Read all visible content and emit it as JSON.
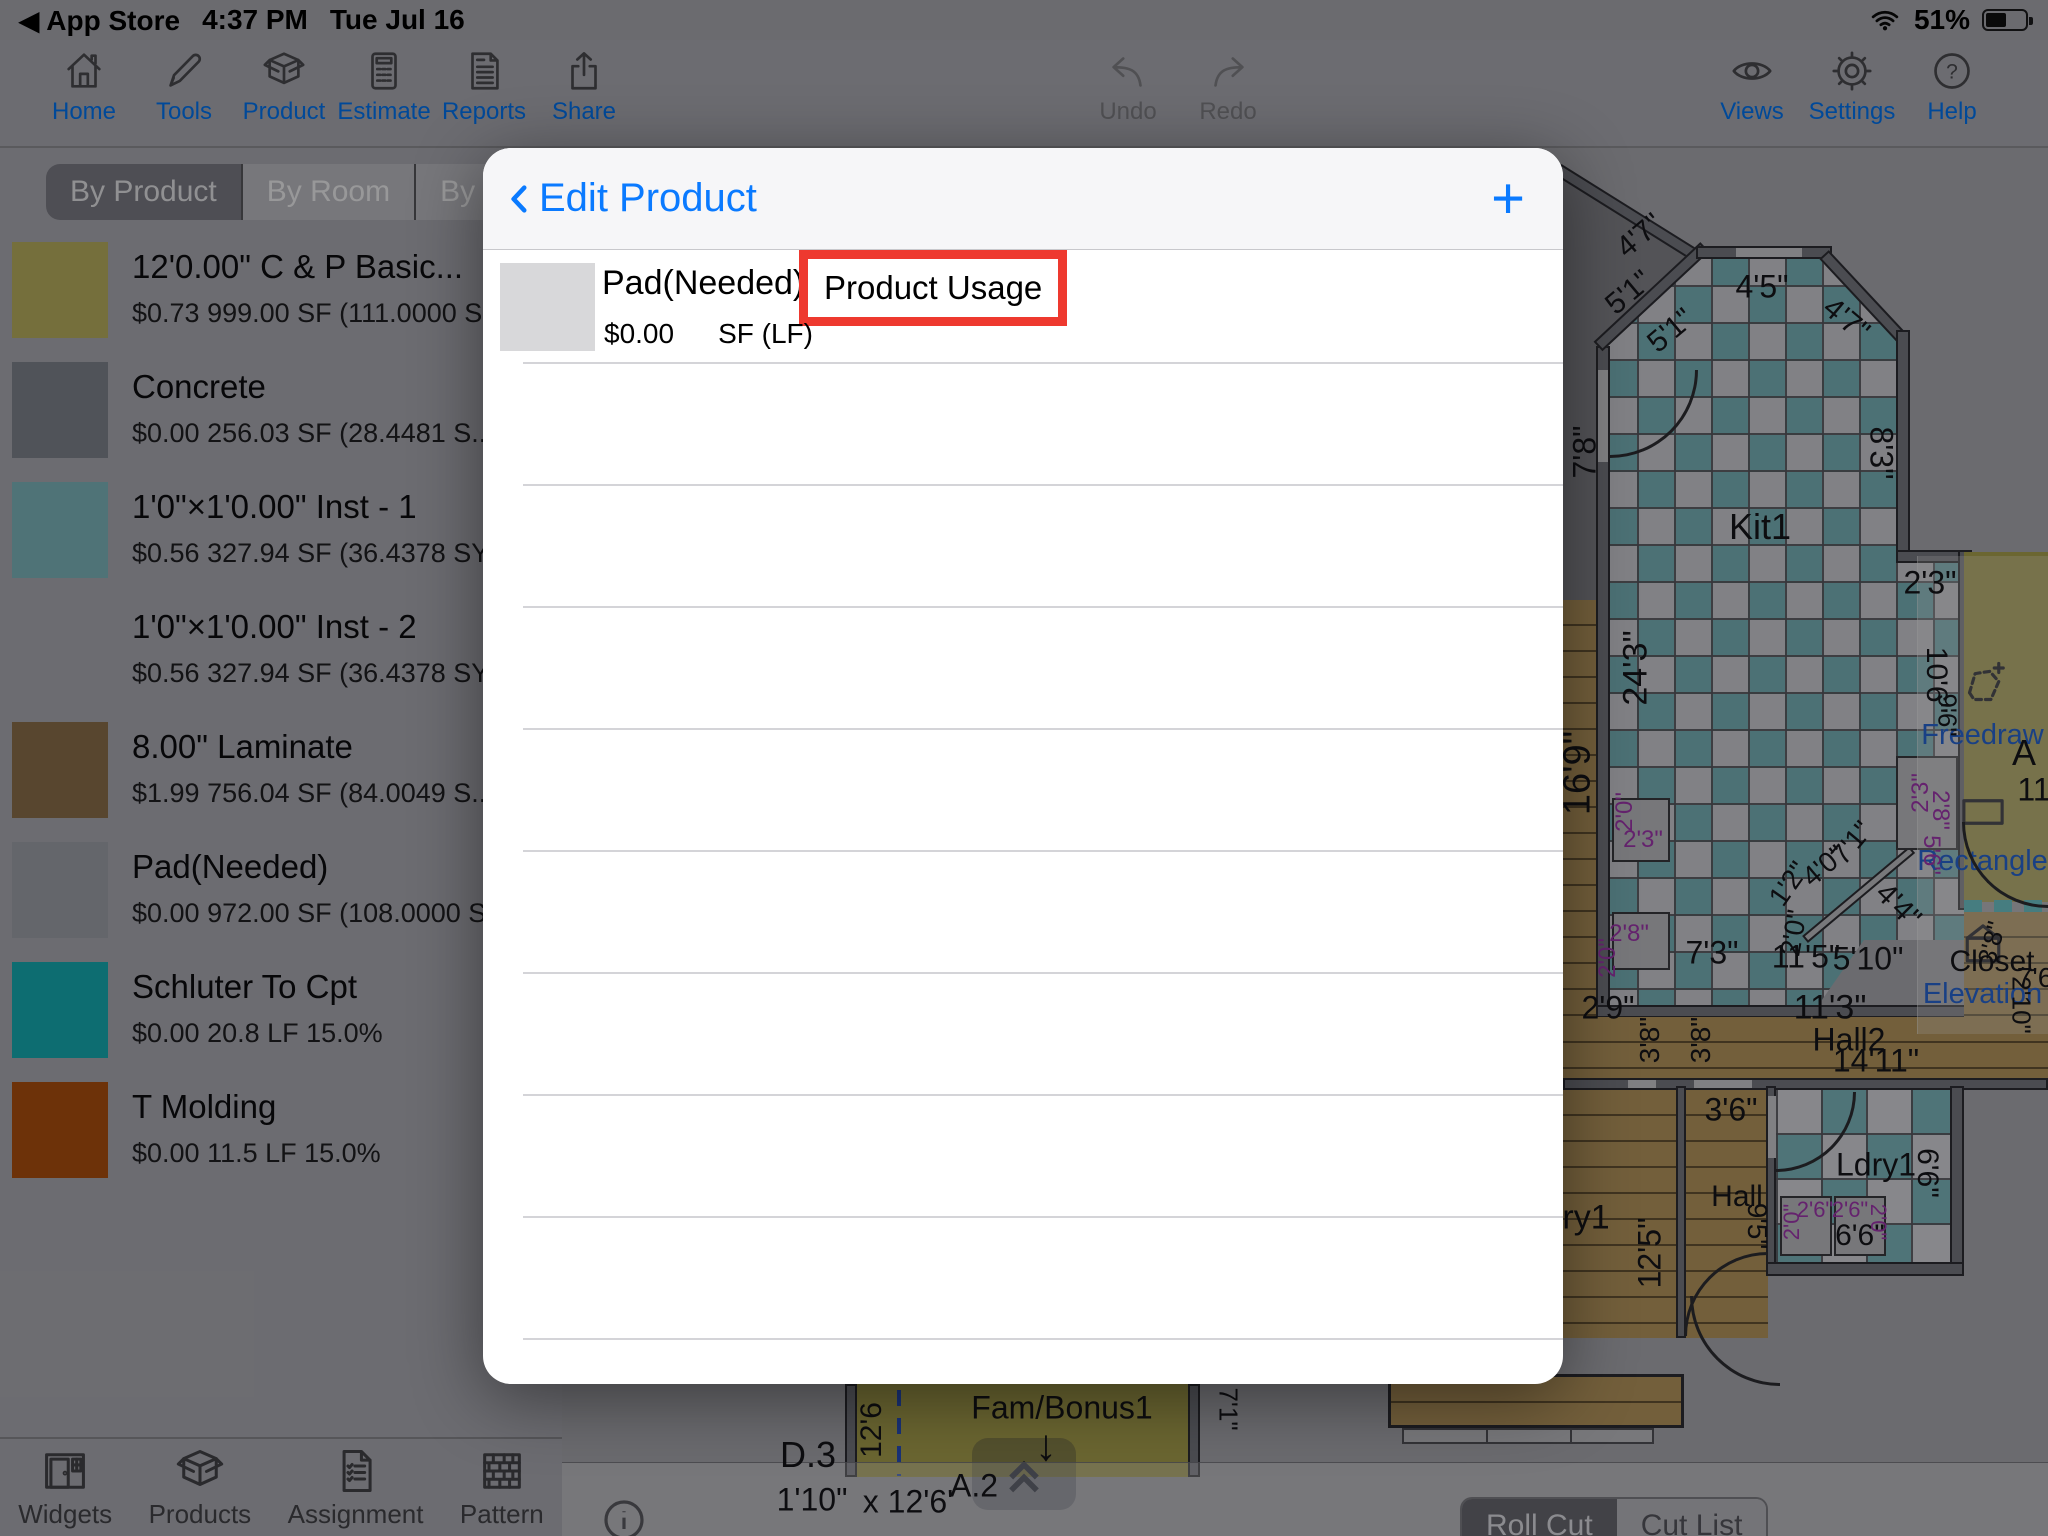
{
  "status_bar": {
    "back": "◀ App Store",
    "time": "4:37 PM",
    "date": "Tue Jul 16",
    "battery_percent": "51%",
    "wifi_icon": "wifi-icon",
    "battery_icon": "battery-icon"
  },
  "toolbar": {
    "accent": "#007aff",
    "left": [
      {
        "icon": "home-icon",
        "label": "Home"
      },
      {
        "icon": "pencil-icon",
        "label": "Tools"
      },
      {
        "icon": "box-icon",
        "label": "Product"
      },
      {
        "icon": "calculator-icon",
        "label": "Estimate"
      },
      {
        "icon": "document-icon",
        "label": "Reports"
      },
      {
        "icon": "share-icon",
        "label": "Share"
      }
    ],
    "center": [
      {
        "icon": "undo-icon",
        "label": "Undo",
        "disabled": true
      },
      {
        "icon": "redo-icon",
        "label": "Redo",
        "disabled": true
      }
    ],
    "right": [
      {
        "icon": "eye-icon",
        "label": "Views"
      },
      {
        "icon": "gear-icon",
        "label": "Settings"
      },
      {
        "icon": "help-icon",
        "label": "Help"
      }
    ]
  },
  "sidebar": {
    "tabs": [
      {
        "label": "By Product",
        "selected": true
      },
      {
        "label": "By Room",
        "selected": false
      },
      {
        "label": "By Patte",
        "selected": false
      }
    ],
    "products": [
      {
        "name": "12'0.00\" C & P Basic...",
        "details": "$0.73 999.00 SF (111.0000 S...",
        "swatch": "#c3b964"
      },
      {
        "name": "Concrete",
        "details": "$0.00 256.03 SF (28.4481 S...",
        "swatch": "#868a94"
      },
      {
        "name": "1'0\"×1'0.00\" Inst -  1",
        "details": "$0.56 327.94 SF (36.4378 SY...",
        "swatch": "#84c0c6"
      },
      {
        "name": "1'0\"×1'0.00\" Inst -  2",
        "details": "$0.56 327.94 SF (36.4378 SY...",
        "swatch": null
      },
      {
        "name": "8.00\" Laminate",
        "details": "$1.99 756.04 SF (84.0049 S...",
        "swatch": "#93764f"
      },
      {
        "name": "Pad(Needed)",
        "details": "$0.00 972.00 SF (108.0000 S...",
        "swatch": "#a7aab2"
      },
      {
        "name": "Schluter To Cpt",
        "details": "$0.00 20.8 LF 15.0%",
        "swatch": "#16b6bd"
      },
      {
        "name": "T Molding",
        "details": "$0.00 11.5 LF 15.0%",
        "swatch": "#b65410"
      }
    ]
  },
  "bottom_bar": {
    "items": [
      {
        "icon": "widgets-icon",
        "label": "Widgets"
      },
      {
        "icon": "box-icon",
        "label": "Products"
      },
      {
        "icon": "assignment-icon",
        "label": "Assignment"
      },
      {
        "icon": "pattern-icon",
        "label": "Pattern"
      }
    ]
  },
  "modal": {
    "title": "Edit Product",
    "add_button": "+",
    "row": {
      "name": "Pad(Needed)",
      "usage_label": "Product Usage",
      "price": "$0.00",
      "unit": "SF (LF)",
      "swatch": "#d8d8da"
    }
  },
  "annotation": {
    "highlight_color": "#ee392f"
  },
  "canvas": {
    "info_icon": "i",
    "cut_tabs": [
      {
        "label": "Roll Cut",
        "selected": true
      },
      {
        "label": "Cut List",
        "selected": false
      }
    ],
    "palette": {
      "accent": "#2b6cde",
      "items": [
        {
          "icon": "freedraw-icon",
          "label": "Freedraw",
          "y": 737
        },
        {
          "icon": "rectangle-icon",
          "label": "Rectangle",
          "y": 863
        },
        {
          "icon": "elevation-icon",
          "label": "Elevation",
          "y": 996
        }
      ]
    },
    "colors": {
      "tile_teal": "#7fbdc3",
      "tile_light": "#d8d8de",
      "wood": "#c09f63",
      "olive": "#b3aa52",
      "purple": "#a83ab8",
      "wall": "#7e7f88"
    },
    "plan_labels": [
      {
        "t": "4'7\"",
        "x": 1640,
        "y": 236,
        "r": -40,
        "s": 30
      },
      {
        "t": "5'1\"",
        "x": 1629,
        "y": 293,
        "r": -40,
        "s": 30
      },
      {
        "t": "5'1\"",
        "x": 1671,
        "y": 331,
        "r": -40,
        "s": 30
      },
      {
        "t": "4'5\"",
        "x": 1762,
        "y": 287,
        "r": 0,
        "s": 32
      },
      {
        "t": "4'7\"",
        "x": 1846,
        "y": 320,
        "r": 40,
        "s": 30
      },
      {
        "t": "7'8\"",
        "x": 1585,
        "y": 452,
        "r": -90,
        "s": 32
      },
      {
        "t": "8'3\"",
        "x": 1881,
        "y": 453,
        "r": 90,
        "s": 32
      },
      {
        "t": "Kit1",
        "x": 1760,
        "y": 527,
        "r": 0,
        "s": 36
      },
      {
        "t": "2'3\"",
        "x": 1930,
        "y": 583,
        "r": 0,
        "s": 32
      },
      {
        "t": "24'3\"",
        "x": 1636,
        "y": 668,
        "r": -90,
        "s": 34
      },
      {
        "t": "16'9\"",
        "x": 1578,
        "y": 773,
        "r": -90,
        "s": 38
      },
      {
        "t": "10'6\"",
        "x": 1936,
        "y": 680,
        "r": 90,
        "s": 30
      },
      {
        "t": "9'6\"",
        "x": 1947,
        "y": 715,
        "r": 90,
        "s": 26
      },
      {
        "t": "2'0\"",
        "x": 1625,
        "y": 812,
        "r": -90,
        "s": 24,
        "c": "purple"
      },
      {
        "t": "2'3\"",
        "x": 1643,
        "y": 840,
        "r": 0,
        "s": 24,
        "c": "purple"
      },
      {
        "t": "2'8\"",
        "x": 1629,
        "y": 934,
        "r": 0,
        "s": 24,
        "c": "purple"
      },
      {
        "t": "2'0\"",
        "x": 1608,
        "y": 958,
        "r": -90,
        "s": 24,
        "c": "purple"
      },
      {
        "t": "2'3\"",
        "x": 1921,
        "y": 793,
        "r": -90,
        "s": 24,
        "c": "purple"
      },
      {
        "t": "2'8\"",
        "x": 1940,
        "y": 810,
        "r": 90,
        "s": 24,
        "c": "purple"
      },
      {
        "t": "5'6\"",
        "x": 1931,
        "y": 855,
        "r": 90,
        "s": 24,
        "c": "purple"
      },
      {
        "t": "1'2\"",
        "x": 1789,
        "y": 884,
        "r": -55,
        "s": 28
      },
      {
        "t": "4'0\"",
        "x": 1824,
        "y": 866,
        "r": -40,
        "s": 28
      },
      {
        "t": "7'1\"",
        "x": 1852,
        "y": 843,
        "r": -50,
        "s": 28
      },
      {
        "t": "4'4\"",
        "x": 1898,
        "y": 906,
        "r": 45,
        "s": 30
      },
      {
        "t": "2'0\"",
        "x": 1794,
        "y": 933,
        "r": -80,
        "s": 28
      },
      {
        "t": "7'3\"",
        "x": 1712,
        "y": 953,
        "r": 0,
        "s": 32
      },
      {
        "t": "11'5\"",
        "x": 1806,
        "y": 957,
        "r": 0,
        "s": 32
      },
      {
        "t": "5'10\"",
        "x": 1868,
        "y": 959,
        "r": 0,
        "s": 32
      },
      {
        "t": "Closet",
        "x": 1992,
        "y": 962,
        "r": 0,
        "s": 30
      },
      {
        "t": "7'6\"",
        "x": 2040,
        "y": 978,
        "r": 0,
        "s": 28
      },
      {
        "t": "2'9\"",
        "x": 1608,
        "y": 1008,
        "r": 0,
        "s": 32
      },
      {
        "t": "3'8\"",
        "x": 1650,
        "y": 1040,
        "r": -90,
        "s": 28
      },
      {
        "t": "3'8\"",
        "x": 1701,
        "y": 1040,
        "r": -90,
        "s": 28
      },
      {
        "t": "3'8\"",
        "x": 1992,
        "y": 943,
        "r": -75,
        "s": 26
      },
      {
        "t": "2'10\"",
        "x": 2021,
        "y": 1005,
        "r": 90,
        "s": 26
      },
      {
        "t": "11'3\"",
        "x": 1830,
        "y": 1008,
        "r": 0,
        "s": 34
      },
      {
        "t": "Hall2",
        "x": 1849,
        "y": 1040,
        "r": 0,
        "s": 32
      },
      {
        "t": "14'11\"",
        "x": 1876,
        "y": 1061,
        "r": 0,
        "s": 32
      },
      {
        "t": "3'6\"",
        "x": 1731,
        "y": 1110,
        "r": 0,
        "s": 32
      },
      {
        "t": "Ldry1",
        "x": 1876,
        "y": 1165,
        "r": 0,
        "s": 32
      },
      {
        "t": "6'6\"",
        "x": 1927,
        "y": 1173,
        "r": 90,
        "s": 30
      },
      {
        "t": "6'6\"",
        "x": 1860,
        "y": 1236,
        "r": 0,
        "s": 30
      },
      {
        "t": "2'0\"",
        "x": 1792,
        "y": 1222,
        "r": -90,
        "s": 22,
        "c": "purple"
      },
      {
        "t": "2'6\"",
        "x": 1815,
        "y": 1210,
        "r": 0,
        "s": 22,
        "c": "purple"
      },
      {
        "t": "2'6\"",
        "x": 1850,
        "y": 1210,
        "r": 0,
        "s": 22,
        "c": "purple"
      },
      {
        "t": "2'0\"",
        "x": 1878,
        "y": 1222,
        "r": 90,
        "s": 22,
        "c": "purple"
      },
      {
        "t": "Hall",
        "x": 1737,
        "y": 1197,
        "r": 0,
        "s": 30
      },
      {
        "t": "9'5\"",
        "x": 1757,
        "y": 1226,
        "r": 90,
        "s": 28
      },
      {
        "t": "ry1",
        "x": 1586,
        "y": 1218,
        "r": 0,
        "s": 34
      },
      {
        "t": "12'5\"",
        "x": 1650,
        "y": 1253,
        "r": -90,
        "s": 32
      },
      {
        "t": "D.3",
        "x": 808,
        "y": 1455,
        "r": 0,
        "s": 36
      },
      {
        "t": "1'10\"",
        "x": 812,
        "y": 1500,
        "r": 0,
        "s": 32
      },
      {
        "t": "x 12'6'",
        "x": 908,
        "y": 1502,
        "r": 0,
        "s": 32
      },
      {
        "t": "12'6",
        "x": 872,
        "y": 1430,
        "r": -90,
        "s": 30
      },
      {
        "t": "Fam/Bonus1",
        "x": 1062,
        "y": 1408,
        "r": 0,
        "s": 32
      },
      {
        "t": "A.2",
        "x": 974,
        "y": 1486,
        "r": 0,
        "s": 32
      },
      {
        "t": "↓",
        "x": 1046,
        "y": 1446,
        "r": 0,
        "s": 44
      },
      {
        "t": "7'1\"",
        "x": 1228,
        "y": 1409,
        "r": 90,
        "s": 26
      },
      {
        "t": "A",
        "x": 2024,
        "y": 753,
        "r": 0,
        "s": 36
      },
      {
        "t": "11",
        "x": 2034,
        "y": 790,
        "r": 0,
        "s": 32
      }
    ]
  }
}
